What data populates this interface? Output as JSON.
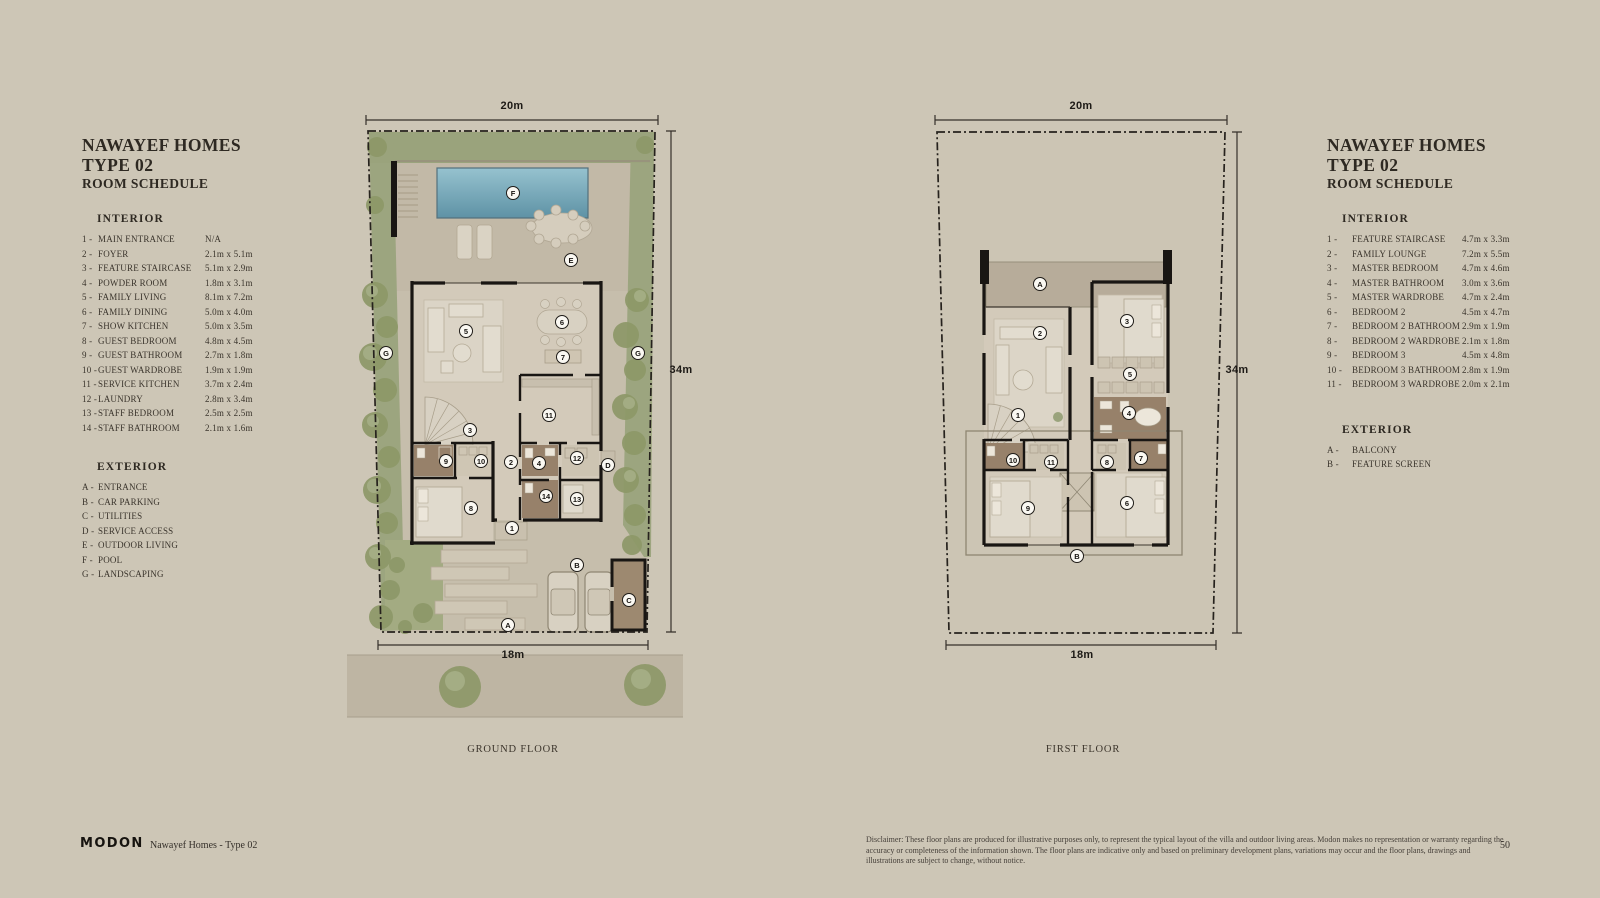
{
  "page": {
    "background": "#cdc6b6",
    "number": "50"
  },
  "brand": {
    "logo": "MODON",
    "project": "Nawayef Homes - Type 02"
  },
  "disclaimer": "Disclaimer: These floor plans are produced for illustrative purposes only, to represent the typical layout of the villa and outdoor living areas.  Modon makes no representation or warranty regarding the accuracy or completeness of the information shown.  The floor plans are indicative only and based on preliminary development plans, variations may occur and the floor plans, drawings and illustrations are subject to change, without notice.",
  "left_schedule": {
    "title_line1": "NAWAYEF HOMES",
    "title_line2": "TYPE 02",
    "subtitle": "ROOM SCHEDULE",
    "interior_heading": "INTERIOR",
    "interior": [
      {
        "num": "1",
        "name": "MAIN ENTRANCE",
        "dim": "N/A"
      },
      {
        "num": "2",
        "name": "FOYER",
        "dim": "2.1m x 5.1m"
      },
      {
        "num": "3",
        "name": "FEATURE STAIRCASE",
        "dim": "5.1m x 2.9m"
      },
      {
        "num": "4",
        "name": "POWDER ROOM",
        "dim": "1.8m x 3.1m"
      },
      {
        "num": "5",
        "name": "FAMILY LIVING",
        "dim": "8.1m x 7.2m"
      },
      {
        "num": "6",
        "name": "FAMILY DINING",
        "dim": "5.0m x 4.0m"
      },
      {
        "num": "7",
        "name": "SHOW KITCHEN",
        "dim": "5.0m x 3.5m"
      },
      {
        "num": "8",
        "name": "GUEST BEDROOM",
        "dim": "4.8m x 4.5m"
      },
      {
        "num": "9",
        "name": "GUEST BATHROOM",
        "dim": "2.7m x 1.8m"
      },
      {
        "num": "10",
        "name": "GUEST WARDROBE",
        "dim": "1.9m x 1.9m"
      },
      {
        "num": "11",
        "name": "SERVICE KITCHEN",
        "dim": "3.7m x 2.4m"
      },
      {
        "num": "12",
        "name": "LAUNDRY",
        "dim": "2.8m x 3.4m"
      },
      {
        "num": "13",
        "name": "STAFF BEDROOM",
        "dim": "2.5m x 2.5m"
      },
      {
        "num": "14",
        "name": "STAFF BATHROOM",
        "dim": "2.1m x 1.6m"
      }
    ],
    "exterior_heading": "EXTERIOR",
    "exterior": [
      {
        "num": "A",
        "name": "ENTRANCE"
      },
      {
        "num": "B",
        "name": "CAR PARKING"
      },
      {
        "num": "C",
        "name": "UTILITIES"
      },
      {
        "num": "D",
        "name": "SERVICE ACCESS"
      },
      {
        "num": "E",
        "name": "OUTDOOR LIVING"
      },
      {
        "num": "F",
        "name": "POOL"
      },
      {
        "num": "G",
        "name": "LANDSCAPING"
      }
    ]
  },
  "right_schedule": {
    "title_line1": "NAWAYEF HOMES",
    "title_line2": "TYPE 02",
    "subtitle": "ROOM SCHEDULE",
    "interior_heading": "INTERIOR",
    "interior": [
      {
        "num": "1",
        "name": "FEATURE STAIRCASE",
        "dim": "4.7m x 3.3m"
      },
      {
        "num": "2",
        "name": "FAMILY LOUNGE",
        "dim": "7.2m x 5.5m"
      },
      {
        "num": "3",
        "name": "MASTER BEDROOM",
        "dim": "4.7m x 4.6m"
      },
      {
        "num": "4",
        "name": "MASTER BATHROOM",
        "dim": "3.0m x 3.6m"
      },
      {
        "num": "5",
        "name": "MASTER WARDROBE",
        "dim": "4.7m x 2.4m"
      },
      {
        "num": "6",
        "name": "BEDROOM 2",
        "dim": "4.5m x 4.7m"
      },
      {
        "num": "7",
        "name": "BEDROOM 2 BATHROOM",
        "dim": "2.9m x 1.9m"
      },
      {
        "num": "8",
        "name": "BEDROOM 2 WARDROBE",
        "dim": "2.1m x 1.8m"
      },
      {
        "num": "9",
        "name": "BEDROOM 3",
        "dim": "4.5m x 4.8m"
      },
      {
        "num": "10",
        "name": "BEDROOM 3 BATHROOM",
        "dim": "2.8m x 1.9m"
      },
      {
        "num": "11",
        "name": "BEDROOM 3 WARDROBE",
        "dim": "2.0m x 2.1m"
      }
    ],
    "exterior_heading": "EXTERIOR",
    "exterior": [
      {
        "num": "A",
        "name": "BALCONY"
      },
      {
        "num": "B",
        "name": "FEATURE SCREEN"
      }
    ]
  },
  "plans": {
    "ground": {
      "caption": "GROUND FLOOR",
      "dims": [
        {
          "t": "20m",
          "x": 512,
          "y": 106
        },
        {
          "t": "34m",
          "x": 681,
          "y": 370
        },
        {
          "t": "18m",
          "x": 513,
          "y": 655
        }
      ],
      "markers": [
        {
          "t": "F",
          "x": 513,
          "y": 193
        },
        {
          "t": "E",
          "x": 571,
          "y": 260
        },
        {
          "t": "5",
          "x": 466,
          "y": 331
        },
        {
          "t": "6",
          "x": 562,
          "y": 322
        },
        {
          "t": "7",
          "x": 563,
          "y": 357
        },
        {
          "t": "G",
          "x": 386,
          "y": 353
        },
        {
          "t": "G",
          "x": 638,
          "y": 353
        },
        {
          "t": "3",
          "x": 470,
          "y": 430
        },
        {
          "t": "11",
          "x": 549,
          "y": 415
        },
        {
          "t": "9",
          "x": 446,
          "y": 461
        },
        {
          "t": "10",
          "x": 481,
          "y": 461
        },
        {
          "t": "2",
          "x": 511,
          "y": 462
        },
        {
          "t": "4",
          "x": 539,
          "y": 463
        },
        {
          "t": "12",
          "x": 577,
          "y": 458
        },
        {
          "t": "D",
          "x": 608,
          "y": 465
        },
        {
          "t": "14",
          "x": 546,
          "y": 496
        },
        {
          "t": "13",
          "x": 577,
          "y": 499
        },
        {
          "t": "8",
          "x": 471,
          "y": 508
        },
        {
          "t": "1",
          "x": 512,
          "y": 528
        },
        {
          "t": "B",
          "x": 577,
          "y": 565
        },
        {
          "t": "C",
          "x": 629,
          "y": 600
        },
        {
          "t": "A",
          "x": 508,
          "y": 625
        }
      ]
    },
    "first": {
      "caption": "FIRST FLOOR",
      "dims": [
        {
          "t": "20m",
          "x": 1081,
          "y": 106
        },
        {
          "t": "34m",
          "x": 1237,
          "y": 370
        },
        {
          "t": "18m",
          "x": 1082,
          "y": 655
        }
      ],
      "markers": [
        {
          "t": "A",
          "x": 1040,
          "y": 284
        },
        {
          "t": "2",
          "x": 1040,
          "y": 333
        },
        {
          "t": "3",
          "x": 1127,
          "y": 321
        },
        {
          "t": "5",
          "x": 1130,
          "y": 374
        },
        {
          "t": "1",
          "x": 1018,
          "y": 415
        },
        {
          "t": "4",
          "x": 1129,
          "y": 413
        },
        {
          "t": "10",
          "x": 1013,
          "y": 460
        },
        {
          "t": "11",
          "x": 1051,
          "y": 462
        },
        {
          "t": "8",
          "x": 1107,
          "y": 462
        },
        {
          "t": "7",
          "x": 1141,
          "y": 458
        },
        {
          "t": "9",
          "x": 1028,
          "y": 508
        },
        {
          "t": "6",
          "x": 1127,
          "y": 503
        },
        {
          "t": "B",
          "x": 1077,
          "y": 556
        }
      ]
    }
  }
}
